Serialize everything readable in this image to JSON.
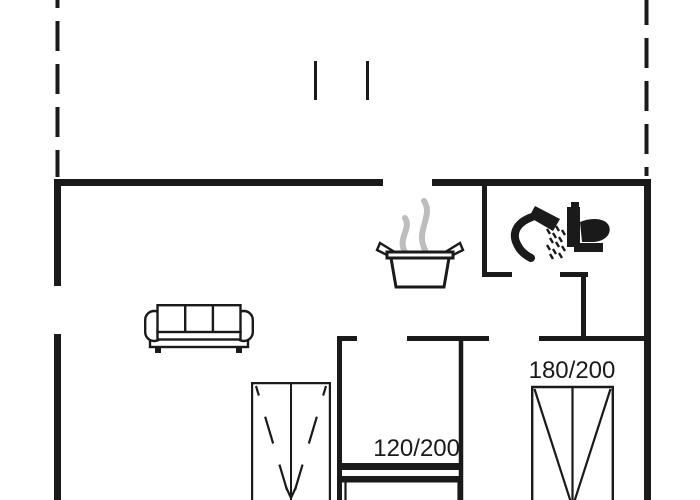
{
  "meta": {
    "background": "#ffffff",
    "wall_color": "#1a1a1a",
    "furniture_color": "#1a1a1a",
    "steam_color": "#bdbdbd",
    "text_color": "#1a1a1a"
  },
  "floor_plan": {
    "type": "floor-plan",
    "labels": {
      "double_bed_size": "180/200",
      "single_bed_size": "120/200"
    },
    "icons": [
      "terrace-boundary-dashed-line",
      "terrace-post",
      "sofa-icon",
      "cooking-pot-icon",
      "steam-icon",
      "shower-icon",
      "toilet-icon",
      "wardrobe-icon",
      "double-bed-icon",
      "single-bed-icon"
    ]
  }
}
